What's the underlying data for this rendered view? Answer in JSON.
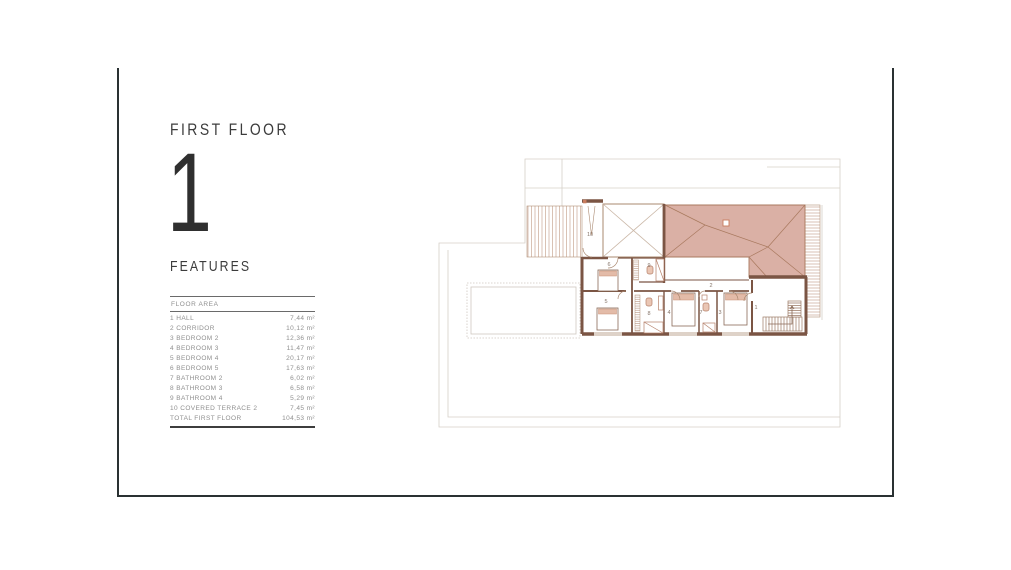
{
  "page": {
    "floor_label": "FIRST FLOOR",
    "floor_number": "1",
    "features_label": "FEATURES",
    "table": {
      "header": "FLOOR AREA",
      "rows": [
        {
          "name": "1 HALL",
          "value": "7,44 m²"
        },
        {
          "name": "2 CORRIDOR",
          "value": "10,12 m²"
        },
        {
          "name": "3 BEDROOM 2",
          "value": "12,36 m²"
        },
        {
          "name": "4 BEDROOM 3",
          "value": "11,47 m²"
        },
        {
          "name": "5 BEDROOM 4",
          "value": "20,17 m²"
        },
        {
          "name": "6 BEDROOM 5",
          "value": "17,63 m²"
        },
        {
          "name": "7 BATHROOM 2",
          "value": "6,02 m²"
        },
        {
          "name": "8 BATHROOM 3",
          "value": "6,58 m²"
        },
        {
          "name": "9 BATHROOM 4",
          "value": "5,29 m²"
        },
        {
          "name": "10 COVERED TERRACE 2",
          "value": "7,45 m²"
        }
      ],
      "total": {
        "name": "TOTAL FIRST FLOOR",
        "value": "104,53 m²"
      }
    }
  },
  "plan": {
    "room_labels": [
      "1",
      "2",
      "3",
      "4",
      "5",
      "6",
      "7",
      "8",
      "9",
      "10"
    ],
    "colors": {
      "roof_fill": "#d3a295",
      "wall": "#7b5544",
      "thin_line": "#a9886f",
      "hatch": "#c9a794",
      "faint": "#d6d0c8",
      "accent": "#c97c5e",
      "card_border": "#2a3132"
    }
  }
}
